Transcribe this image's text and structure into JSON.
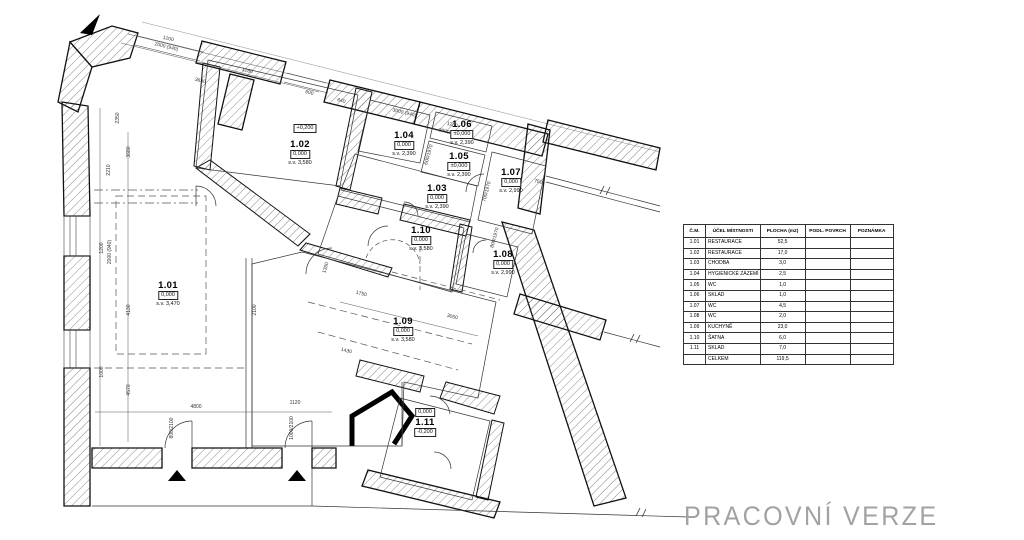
{
  "status_text": "PRACOVNÍ VERZE",
  "colors": {
    "line": "#1a1a1a",
    "hatch": "#555555",
    "dim_text": "#333333",
    "watermark": "#a2a2a2"
  },
  "plan": {
    "rooms": [
      {
        "id": "1.01",
        "level": "0,000",
        "height": "s.v. 3,470"
      },
      {
        "id": "1.02",
        "level": "0,000",
        "height": "s.v. 3,580"
      },
      {
        "id": "1.03",
        "level": "0,000",
        "height": "s.v. 2,390"
      },
      {
        "id": "1.04",
        "level": "0,000",
        "height": "s.v. 2,390"
      },
      {
        "id": "1.05",
        "level": "±0,000",
        "height": "s.v. 2,390"
      },
      {
        "id": "1.06",
        "level": "±0,000",
        "height": "s.v. 2,390"
      },
      {
        "id": "1.07",
        "level": "0,000",
        "height": "s.v. 2,990"
      },
      {
        "id": "1.08",
        "level": "0,000",
        "height": "s.v. 2,990"
      },
      {
        "id": "1.09",
        "level": "0,000",
        "height": "s.v. 3,580"
      },
      {
        "id": "1.10",
        "level": "0,000",
        "height": "s.v. 3,580"
      },
      {
        "id": "1.11",
        "level": "0,000",
        "level_below": "-0,200",
        "height": ""
      }
    ],
    "extra_labels": [
      "+0,200"
    ],
    "dimensions": [
      "1200",
      "2000 (940)",
      "3630",
      "1280",
      "600",
      "640",
      "3000 (940)",
      "1200",
      "2000 (940)",
      "2210",
      "3680",
      "1200",
      "2000 (940)",
      "4130",
      "1000",
      "4570",
      "4800",
      "1120",
      "800/2100",
      "1000/2100",
      "1750",
      "3050",
      "1350",
      "600/1970",
      "700/1970",
      "800/1970",
      "750",
      "2350",
      "1430",
      "2100"
    ]
  },
  "table": {
    "headers": [
      "Č.M.",
      "ÚČEL MÍSTNOSTI",
      "PLOCHA (m2)",
      "PODL. POVRCH",
      "POZNÁMKA"
    ],
    "rows": [
      [
        "1.01",
        "RESTAURACE",
        "52,5",
        "",
        ""
      ],
      [
        "1.02",
        "RESTAURACE",
        "17,0",
        "",
        ""
      ],
      [
        "1.03",
        "CHODBA",
        "3,0",
        "",
        ""
      ],
      [
        "1.04",
        "HYGIENICKÉ ZÁZEMÍ",
        "2,5",
        "",
        ""
      ],
      [
        "1.05",
        "WC",
        "1,0",
        "",
        ""
      ],
      [
        "1.06",
        "SKLAD",
        "1,0",
        "",
        ""
      ],
      [
        "1.07",
        "WC",
        "4,5",
        "",
        ""
      ],
      [
        "1.08",
        "WC",
        "2,0",
        "",
        ""
      ],
      [
        "1.09",
        "KUCHYNĚ",
        "23,0",
        "",
        ""
      ],
      [
        "1.10",
        "ŠATNA",
        "6,0",
        "",
        ""
      ],
      [
        "1.11",
        "SKLAD",
        "7,0",
        "",
        ""
      ],
      [
        "",
        "CELKEM",
        "119,5",
        "",
        ""
      ]
    ]
  }
}
